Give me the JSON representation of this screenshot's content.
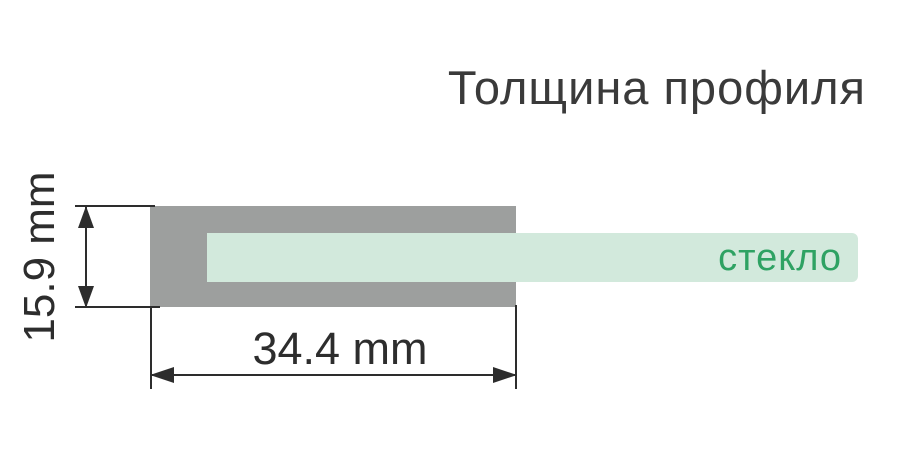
{
  "header": {
    "title": "Толщина профиля"
  },
  "diagram": {
    "glass": {
      "label": "стекло"
    },
    "dimensions": {
      "height": {
        "label": "15.9 mm"
      },
      "width": {
        "label": "34.4 mm"
      }
    },
    "colors": {
      "profile_gray": "#9d9f9e",
      "glass_mint": "#d2e9dc",
      "glass_green": "#2ea263",
      "line_dark": "#2d2d2d",
      "title_gray": "#3a3a3a"
    }
  }
}
